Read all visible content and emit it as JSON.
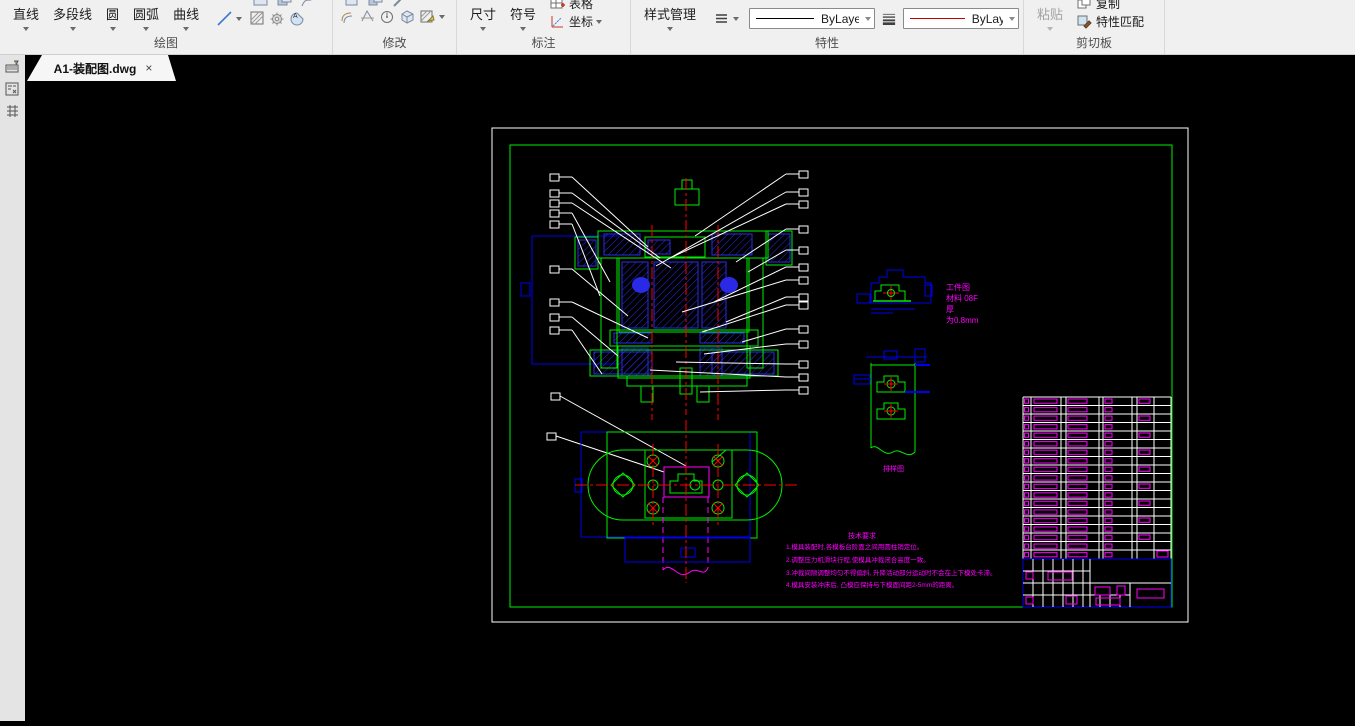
{
  "ribbon": {
    "panels": {
      "draw": {
        "label": "绘图",
        "line": "直线",
        "polyline": "多段线",
        "circle": "圆",
        "arc": "圆弧",
        "curve": "曲线"
      },
      "modify": {
        "label": "修改"
      },
      "annotate": {
        "label": "标注",
        "dimension": "尺寸",
        "symbol": "符号",
        "table": "表格",
        "coordinate": "坐标"
      },
      "properties": {
        "label": "特性",
        "style_manager": "样式管理",
        "linetype_value": "ByLayer",
        "color_value": "ByLayer"
      },
      "clipboard": {
        "label": "剪切板",
        "paste": "粘贴",
        "copy": "复制",
        "match_properties": "特性匹配"
      }
    }
  },
  "tabbar": {
    "active_tab": "A1-装配图.dwg",
    "close": "×"
  },
  "drawing": {
    "workpiece_note": [
      "工件图",
      "材料 08F",
      "厚",
      "为0.8mm"
    ],
    "strip_label": "排样图",
    "tech_requirements": {
      "title": "技术要求",
      "items": [
        "1.模具装配时,各模板台阶面之间用圆柱销定位。",
        "2.调整压力机滑块行程,使模具冲裁闭合高度一致。",
        "3.冲裁间隙调整均匀不得偏斜, 升降活动部分运动时不会在上下模处卡滞。",
        "4.模具安装冲床后, 凸模应保持与下模面间距2-5mm的距离。"
      ]
    },
    "colors": {
      "outline": "#00ee00",
      "hatch": "#2a2ae6",
      "centerline": "#ff0000",
      "annotation": "#ff00ff",
      "frame": "#ffffff",
      "selection": "#0000ee"
    }
  }
}
